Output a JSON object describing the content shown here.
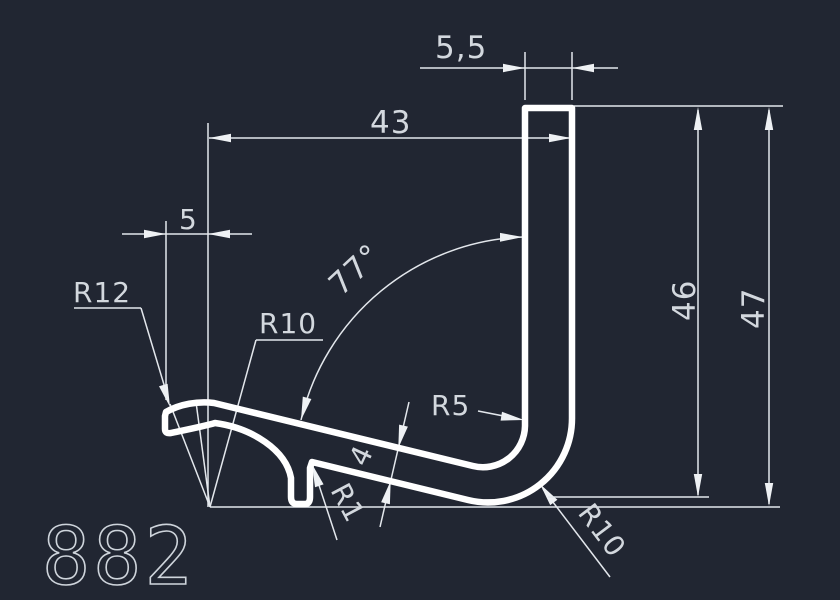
{
  "drawing": {
    "part_number": "882",
    "colors": {
      "background": "#212632",
      "profile_line": "#ffffff",
      "dimension_line": "#e3e7ec",
      "text": "#d3d8de"
    },
    "dimensions": {
      "top_thickness": "5,5",
      "overall_width": "43",
      "left_offset": "5",
      "angle": "77°",
      "leg_thickness": "4",
      "height_inner": "46",
      "height_overall": "47"
    },
    "radii": {
      "left_lip": "R12",
      "crest": "R10",
      "inner_corner": "R5",
      "notch": "R1",
      "outer_corner": "R10"
    }
  }
}
